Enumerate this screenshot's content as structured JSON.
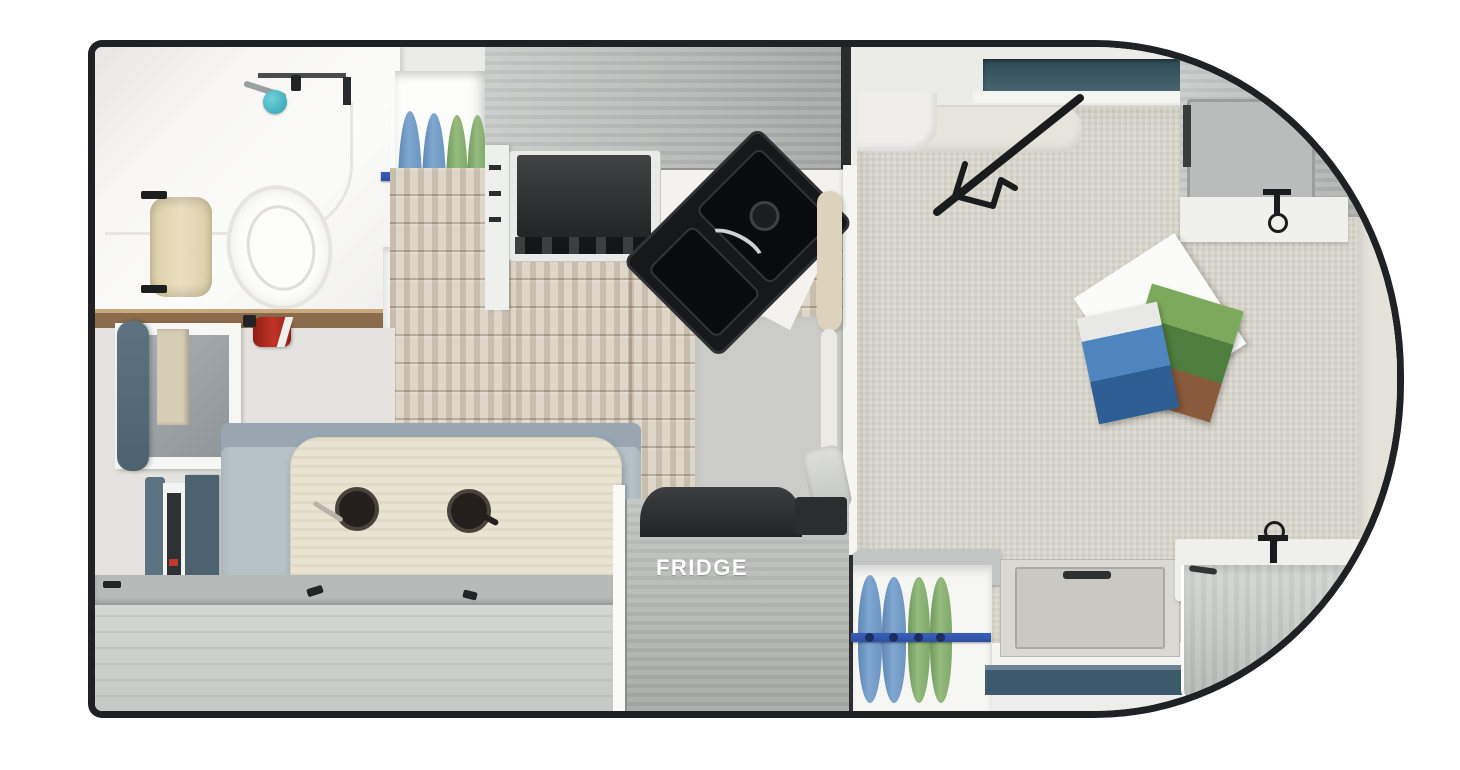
{
  "labels": {
    "fridge": "FRIDGE"
  },
  "palette": {
    "outline": "#202124",
    "cabinet_gray": "#b2b5b3",
    "floor_wood": "#d9d0c1",
    "bed_fabric": "#d6d3c9",
    "bench_slate": "#4d6270",
    "cushion_blue_gray": "#b6c1c8",
    "table_wood": "#e9e3d2",
    "shirt_blue": "#7fa7d0",
    "shirt_green": "#95bb7e",
    "rod_blue": "#2d50a5",
    "sink_black": "#17181a",
    "step_teal": "#3c5a6c",
    "extinguisher_red": "#c23327"
  }
}
